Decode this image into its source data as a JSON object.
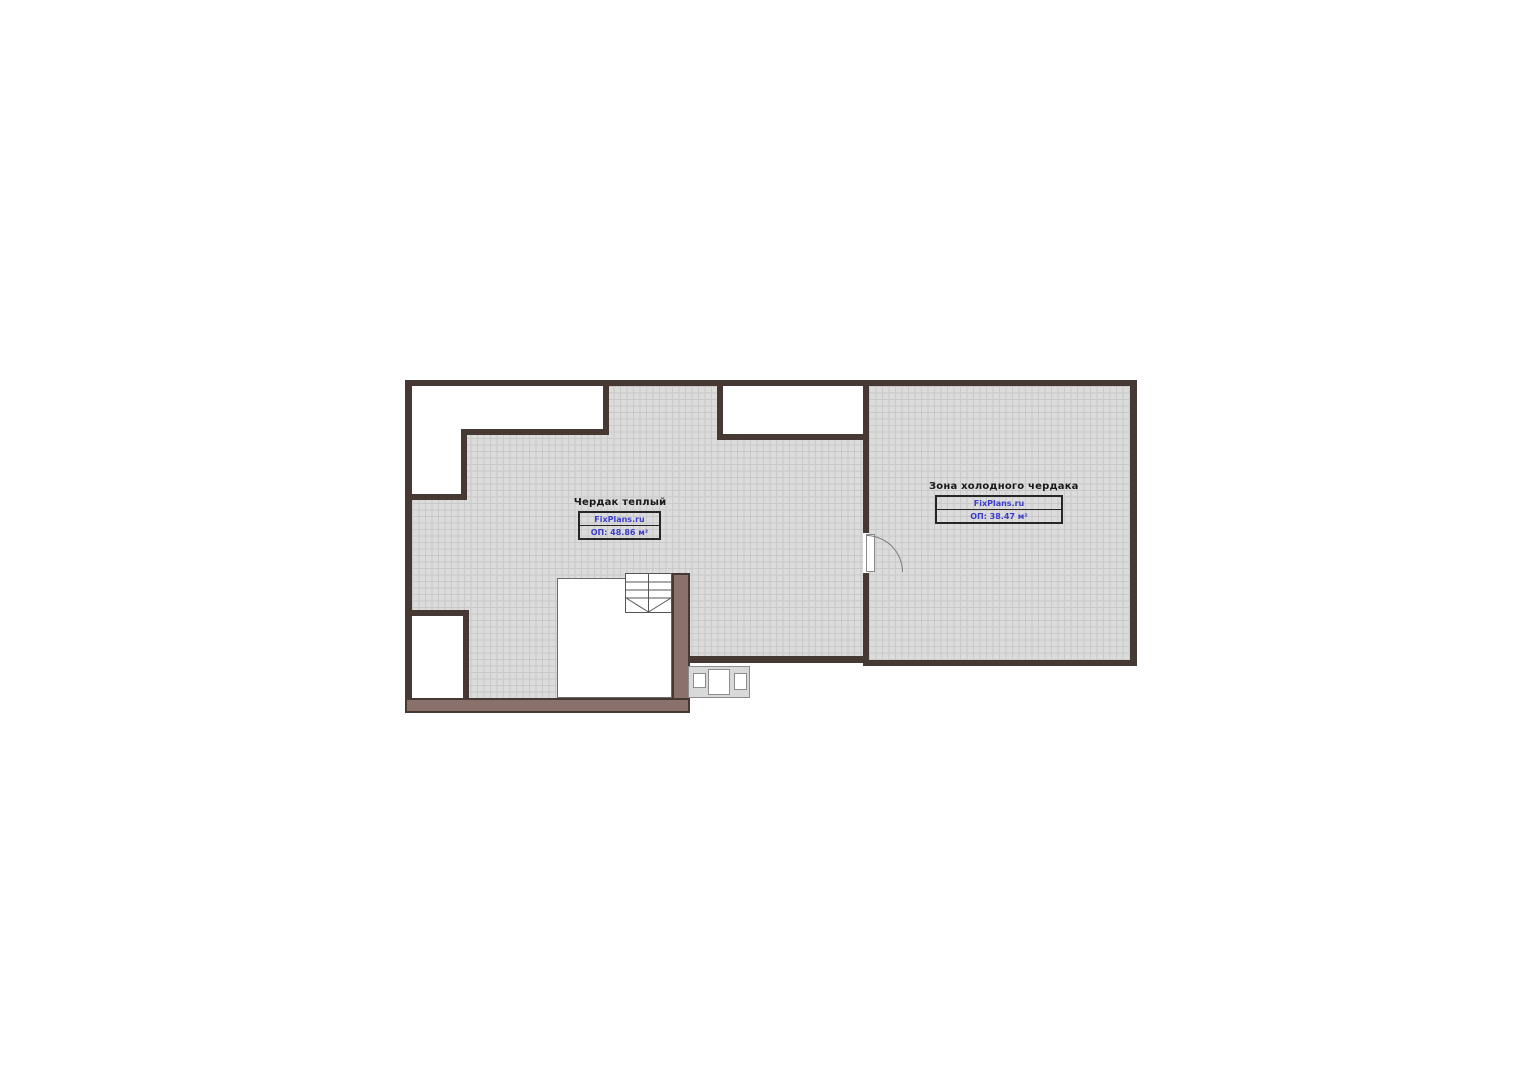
{
  "plan": {
    "colors": {
      "wall": "#463832",
      "thick_wall_fill": "#8a716c",
      "hatch_background": "#dcdcdc",
      "hatch_line": "#8f8f8f",
      "watermark_blue": "#3c3ccc"
    },
    "rooms": [
      {
        "name": "Чердак теплый",
        "watermark": "FixPlans.ru",
        "area_label": "ОП: 48.86 м²"
      },
      {
        "name": "Зона холодного чердака",
        "watermark": "FixPlans.ru",
        "area_label": "ОП: 38.47 м²"
      }
    ]
  }
}
